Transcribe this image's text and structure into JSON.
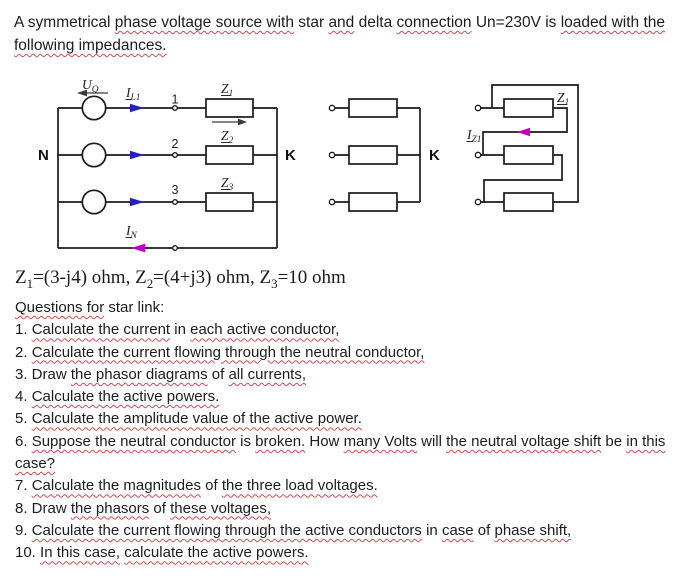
{
  "colors": {
    "squiggle": "#c94f4f",
    "blue": "#2020bd",
    "magenta": "#c000c0",
    "wire": "#1a1a1a",
    "ink": "#1c1c1c"
  },
  "title": {
    "lines": [
      [
        {
          "t": "A symmetrical "
        },
        {
          "t": "phase voltage source with",
          "u": true
        },
        {
          "t": " star "
        },
        {
          "t": "and",
          "u": true
        },
        {
          "t": " delta "
        },
        {
          "t": "connection",
          "u": true
        },
        {
          "t": " Un=230V is "
        },
        {
          "t": "loaded with the",
          "u": true
        }
      ],
      [
        {
          "t": "following impedances.",
          "u": true
        }
      ]
    ]
  },
  "formula": {
    "segments": [
      {
        "t": "Z"
      },
      {
        "t": "1",
        "sub": true
      },
      {
        "t": "=(3-j4) ohm, Z"
      },
      {
        "t": "2",
        "sub": true
      },
      {
        "t": "=(4+j3) ohm, Z"
      },
      {
        "t": "3",
        "sub": true
      },
      {
        "t": "=10 ohm"
      }
    ]
  },
  "questions": {
    "heading": [
      {
        "t": "Questions for",
        "u": true
      },
      {
        "t": " star link:"
      }
    ],
    "lines": [
      [
        {
          "t": "1. "
        },
        {
          "t": "Calculate the current",
          "u": true
        },
        {
          "t": " in "
        },
        {
          "t": "each active conductor,",
          "u": true
        }
      ],
      [
        {
          "t": "2. "
        },
        {
          "t": "Calculate the current flowing through the neutral conductor,",
          "u": true
        }
      ],
      [
        {
          "t": "3. Draw "
        },
        {
          "t": "the phasor diagrams",
          "u": true
        },
        {
          "t": " of "
        },
        {
          "t": "all currents,",
          "u": true
        }
      ],
      [
        {
          "t": "4. "
        },
        {
          "t": "Calculate the active powers.",
          "u": true
        }
      ],
      [
        {
          "t": "5. "
        },
        {
          "t": "Calculate the amplitude value of the active power.",
          "u": true
        }
      ],
      [
        {
          "t": "6. "
        },
        {
          "t": "Suppose the neutral conductor",
          "u": true
        },
        {
          "t": " is "
        },
        {
          "t": "broken.",
          "u": true
        },
        {
          "t": " How "
        },
        {
          "t": "many Volts",
          "u": true
        },
        {
          "t": " will "
        },
        {
          "t": "the neutral voltage shift",
          "u": true
        },
        {
          "t": " be "
        },
        {
          "t": "in this",
          "u": true
        }
      ],
      [
        {
          "t": "case?",
          "u": true
        }
      ],
      [
        {
          "t": "7. "
        },
        {
          "t": "Calculate the magnitudes",
          "u": true
        },
        {
          "t": " of "
        },
        {
          "t": "the three load voltages.",
          "u": true
        }
      ],
      [
        {
          "t": "8. Draw "
        },
        {
          "t": "the phasors",
          "u": true
        },
        {
          "t": " of "
        },
        {
          "t": "these voltages,",
          "u": true
        }
      ],
      [
        {
          "t": "9. "
        },
        {
          "t": "Calculate the current flowing through the active conductors",
          "u": true
        },
        {
          "t": " in "
        },
        {
          "t": "case",
          "u": true
        },
        {
          "t": " of "
        },
        {
          "t": "phase shift,",
          "u": true
        }
      ],
      [
        {
          "t": "10. "
        },
        {
          "t": "In this case,",
          "u": true
        },
        {
          "t": " "
        },
        {
          "t": "calculate the active powers.",
          "u": true
        }
      ]
    ]
  },
  "diagram": {
    "source_voltage": {
      "main": "U",
      "sub": "Q"
    },
    "line_current": {
      "main": "I",
      "sub": "L1"
    },
    "neutral_current": {
      "main": "I",
      "sub": "N"
    },
    "impedances": {
      "z1": {
        "main": "Z",
        "sub": "1"
      },
      "z2": {
        "main": "Z",
        "sub": "2"
      },
      "z3": {
        "main": "Z",
        "sub": "3"
      }
    },
    "nodes": {
      "n1": "1",
      "n2": "2",
      "n3": "3"
    },
    "neutral_node": "N",
    "star_point": "K",
    "star_load_point": "K",
    "delta": {
      "impedance": {
        "main": "Z",
        "sub": "1"
      },
      "current": {
        "main": "I",
        "sub": "Z1"
      }
    }
  }
}
